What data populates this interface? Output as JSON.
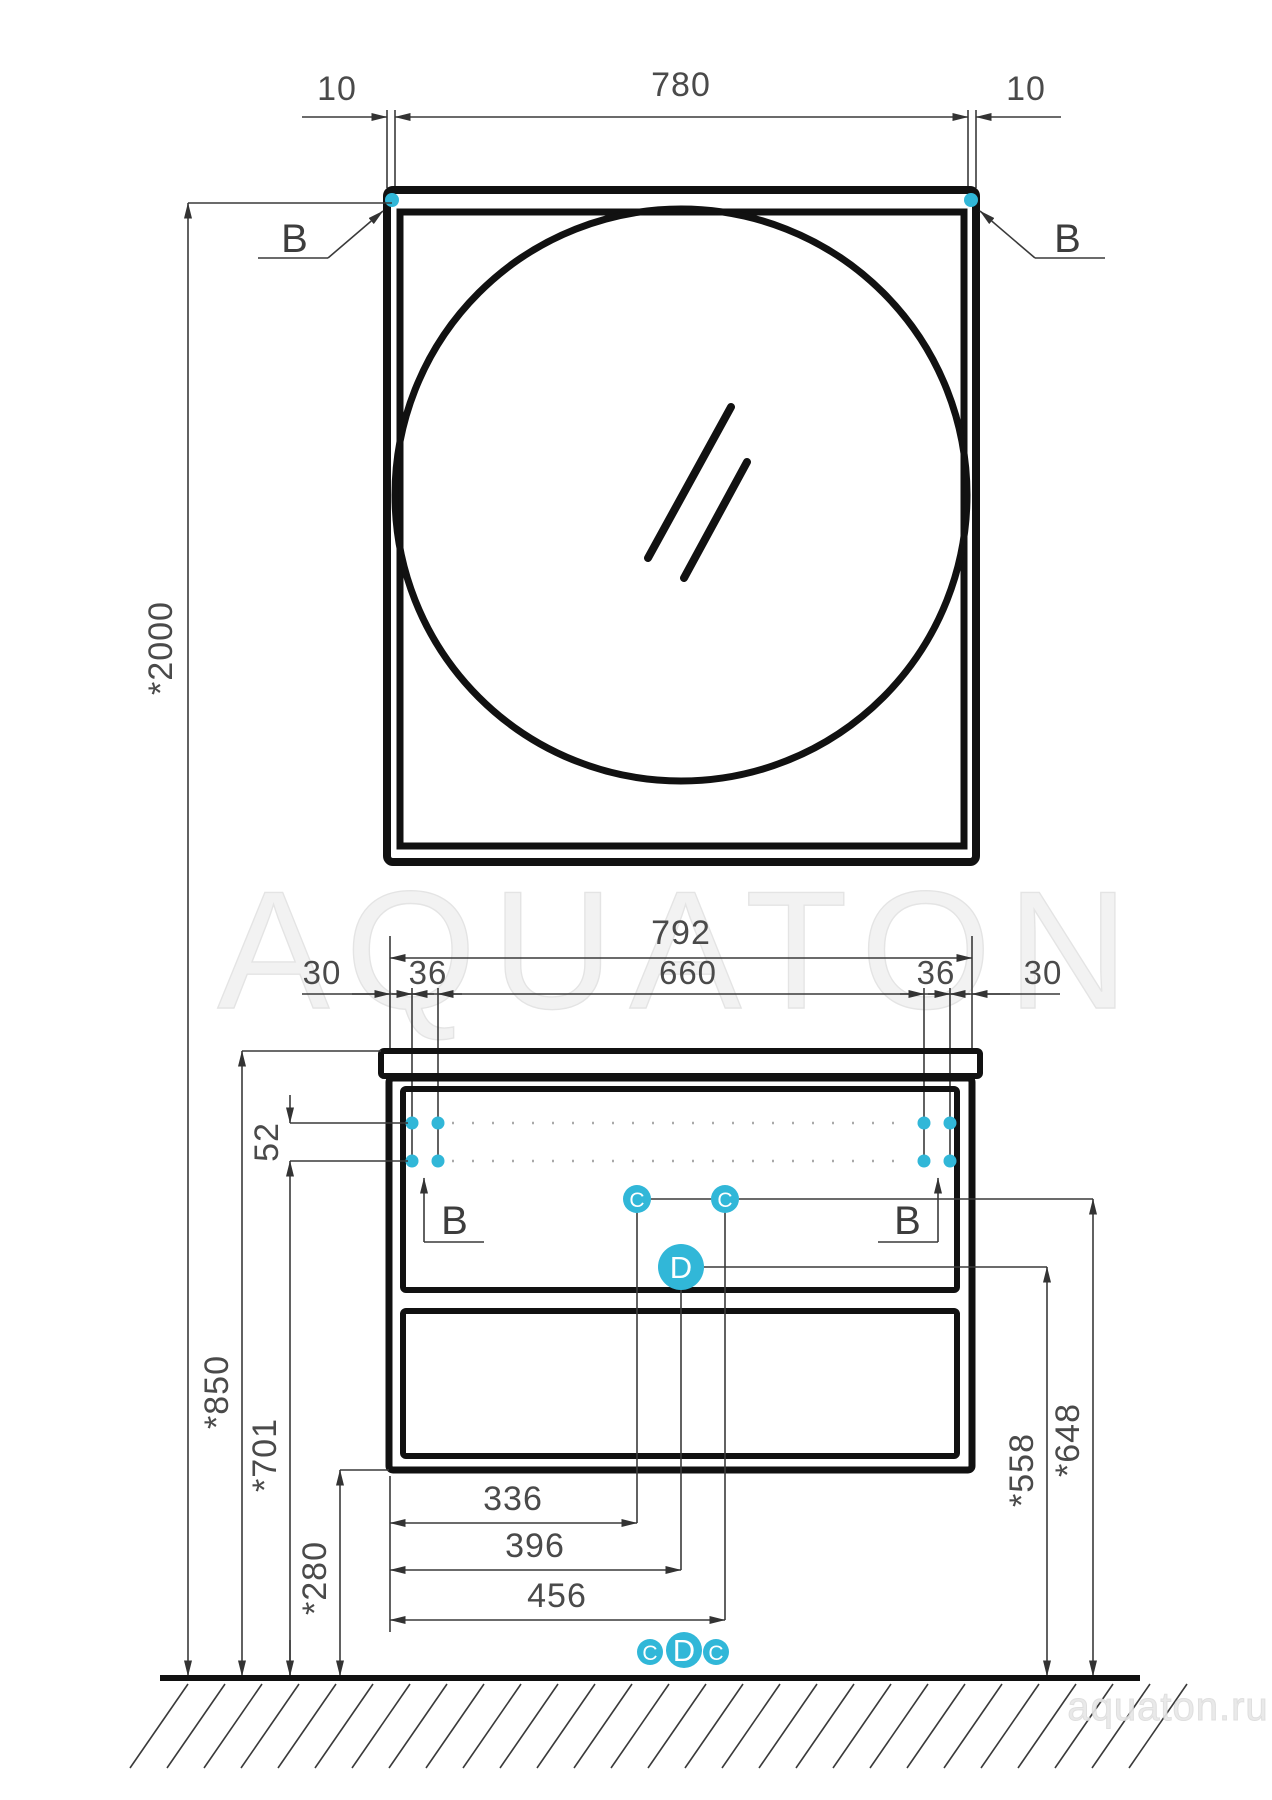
{
  "accent_color": "#31b7d8",
  "watermark": {
    "center": "AQUATON",
    "corner": "aquaton.ru"
  },
  "callouts": {
    "b": "B",
    "c": "C",
    "d": "D"
  },
  "dims": {
    "mirror_offset_left": "10",
    "mirror_width": "780",
    "mirror_offset_right": "10",
    "total_height": "*2000",
    "cabinet_width": "792",
    "chain": [
      "30",
      "36",
      "660",
      "36",
      "30"
    ],
    "screw_row_spacing": "52",
    "worktop_height": "*850",
    "screw_height": "*701",
    "cabinet_bottom_height": "*280",
    "drain_offset_1": "336",
    "drain_offset_2": "396",
    "drain_offset_3": "456",
    "outlet_height_1": "*558",
    "outlet_height_2": "*648"
  }
}
